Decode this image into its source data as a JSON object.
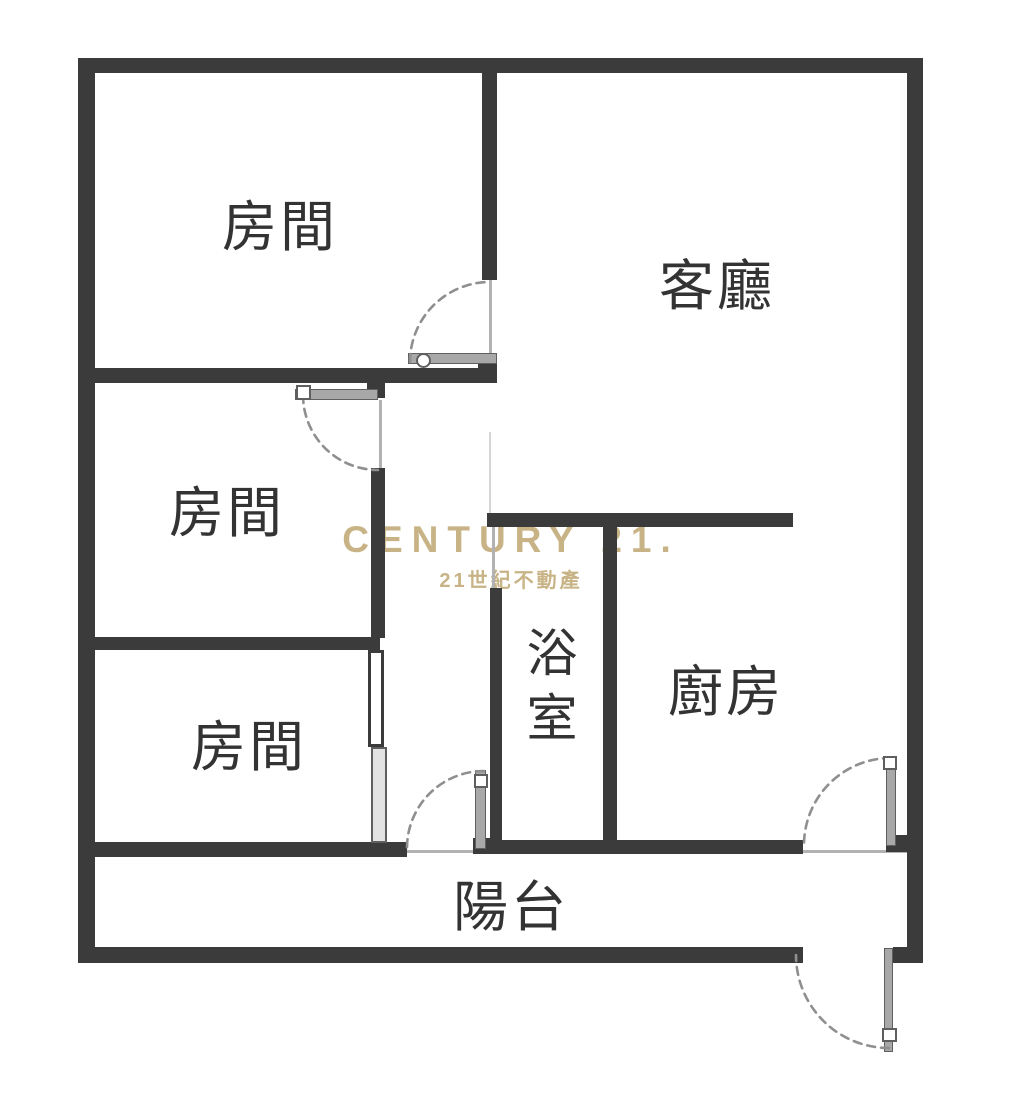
{
  "plan_title": "apartment floor plan",
  "rooms": {
    "bedroom_top": "房間",
    "bedroom_mid": "房間",
    "bedroom_bottom": "房間",
    "living": "客廳",
    "bath": "浴室",
    "kitchen": "廚房",
    "balcony": "陽台"
  },
  "watermark": {
    "brand": "CENTURY 21.",
    "brand_zh": "21世紀不動產"
  },
  "colors": {
    "background": "#ffffff",
    "wall": "#3b3b3b",
    "door_leaf": "#a8a8a8",
    "door_edge": "#5f5f5f",
    "arc": "#8f8f8f",
    "thin_line": "#b2b2b2",
    "label": "#333333",
    "watermark_gold": "#c4ad7c"
  }
}
